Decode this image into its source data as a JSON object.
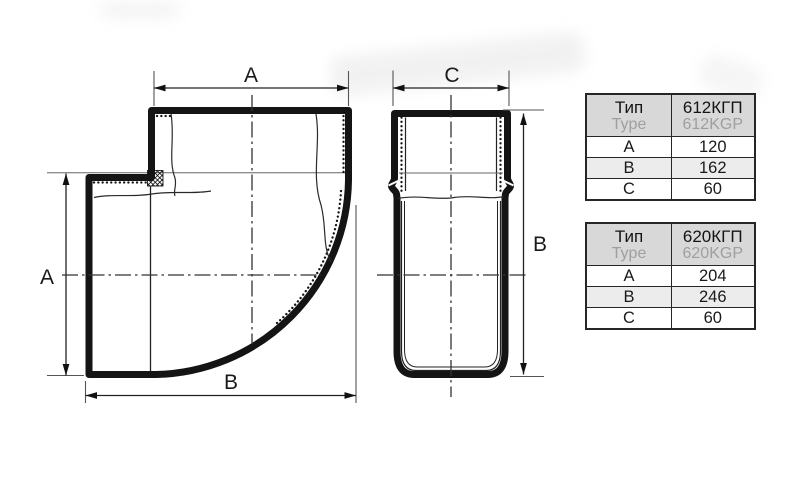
{
  "drawing": {
    "front_view": {
      "top_label": "A",
      "left_label": "A",
      "bottom_label": "B"
    },
    "side_view": {
      "top_label": "C",
      "right_label": "B"
    }
  },
  "tables": [
    {
      "type_ru": "Тип",
      "type_en": "Type",
      "model_ru": "612КГП",
      "model_en": "612KGP",
      "rows": [
        {
          "param": "A",
          "value": "120"
        },
        {
          "param": "B",
          "value": "162"
        },
        {
          "param": "C",
          "value": "60"
        }
      ]
    },
    {
      "type_ru": "Тип",
      "type_en": "Type",
      "model_ru": "620КГП",
      "model_en": "620KGP",
      "rows": [
        {
          "param": "A",
          "value": "204"
        },
        {
          "param": "B",
          "value": "246"
        },
        {
          "param": "C",
          "value": "60"
        }
      ]
    }
  ],
  "colors": {
    "line": "#1a1a1a",
    "dim_line": "#333333",
    "table_header_bg": "#d8d8d8",
    "table_alt_row_bg": "#ececec",
    "muted_text": "#9f9f9f",
    "background": "#ffffff"
  }
}
